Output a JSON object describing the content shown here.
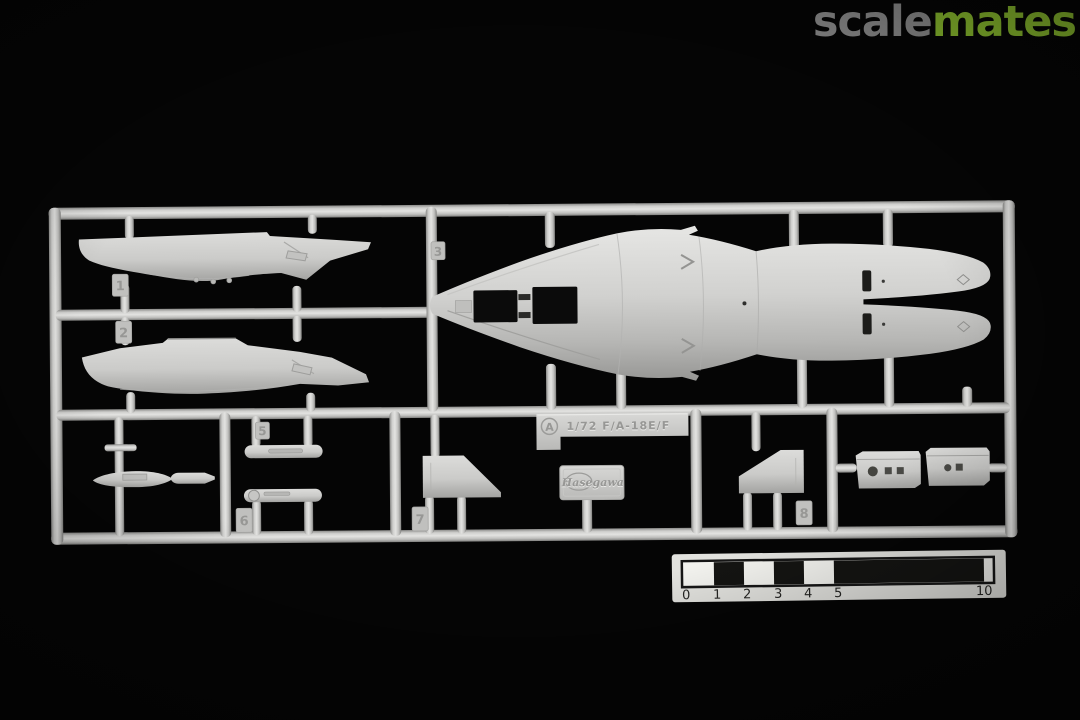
{
  "watermark": {
    "brand_part1": "scale",
    "brand_part2": "mates",
    "brand_color_part1": "#8e8e8e",
    "brand_color_part2": "#8dc02f"
  },
  "sprue": {
    "plastic_color": "#c9c9c7",
    "marking_tag": {
      "letter_badge": "A",
      "scale_text": "1/72 F/A-18E/F"
    },
    "brand_plate_text": "Hasegawa",
    "part_tags": [
      "1",
      "2",
      "3",
      "5",
      "6",
      "7",
      "8"
    ]
  },
  "ruler": {
    "unit_labels": [
      "0",
      "1",
      "2",
      "3",
      "4",
      "5",
      "10"
    ]
  }
}
